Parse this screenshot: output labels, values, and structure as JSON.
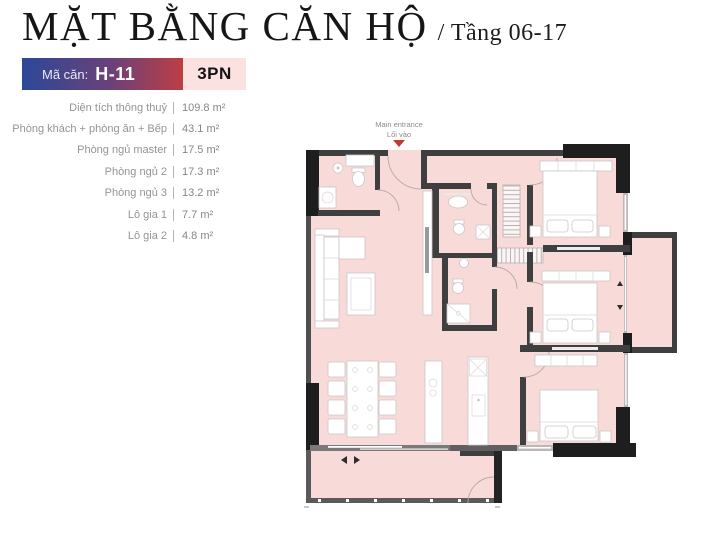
{
  "header": {
    "title": "MẶT BẰNG CĂN HỘ",
    "subtitle": "/ Tầng 06-17"
  },
  "unit_badge": {
    "code_label": "Mã căn:",
    "code": "H-11",
    "type": "3PN",
    "gradient_start": "#2c4897",
    "gradient_end": "#bd3e45",
    "type_bg": "#fbe1df"
  },
  "areas": {
    "items": [
      {
        "label": "Diện tích thông thuỷ",
        "value": "109.8 m²"
      },
      {
        "label": "Phòng khách + phòng ăn + Bếp",
        "value": "43.1 m²"
      },
      {
        "label": "Phòng ngủ master",
        "value": "17.5 m²"
      },
      {
        "label": "Phòng ngủ 2",
        "value": "17.3 m²"
      },
      {
        "label": "Phòng ngủ 3",
        "value": "13.2 m²"
      },
      {
        "label": "Lô gia 1",
        "value": "7.7 m²"
      },
      {
        "label": "Lô gia 2",
        "value": "4.8 m²"
      }
    ]
  },
  "floor_plan": {
    "entrance_label_en": "Main entrance",
    "entrance_label_vi": "Lối vào",
    "colors": {
      "floor": "#f8dad9",
      "wall_dark": "#3f3f3f",
      "wall_black": "#1e1e1e",
      "window": "#bdb8b7",
      "entrance_arrow": "#c2392e"
    }
  }
}
